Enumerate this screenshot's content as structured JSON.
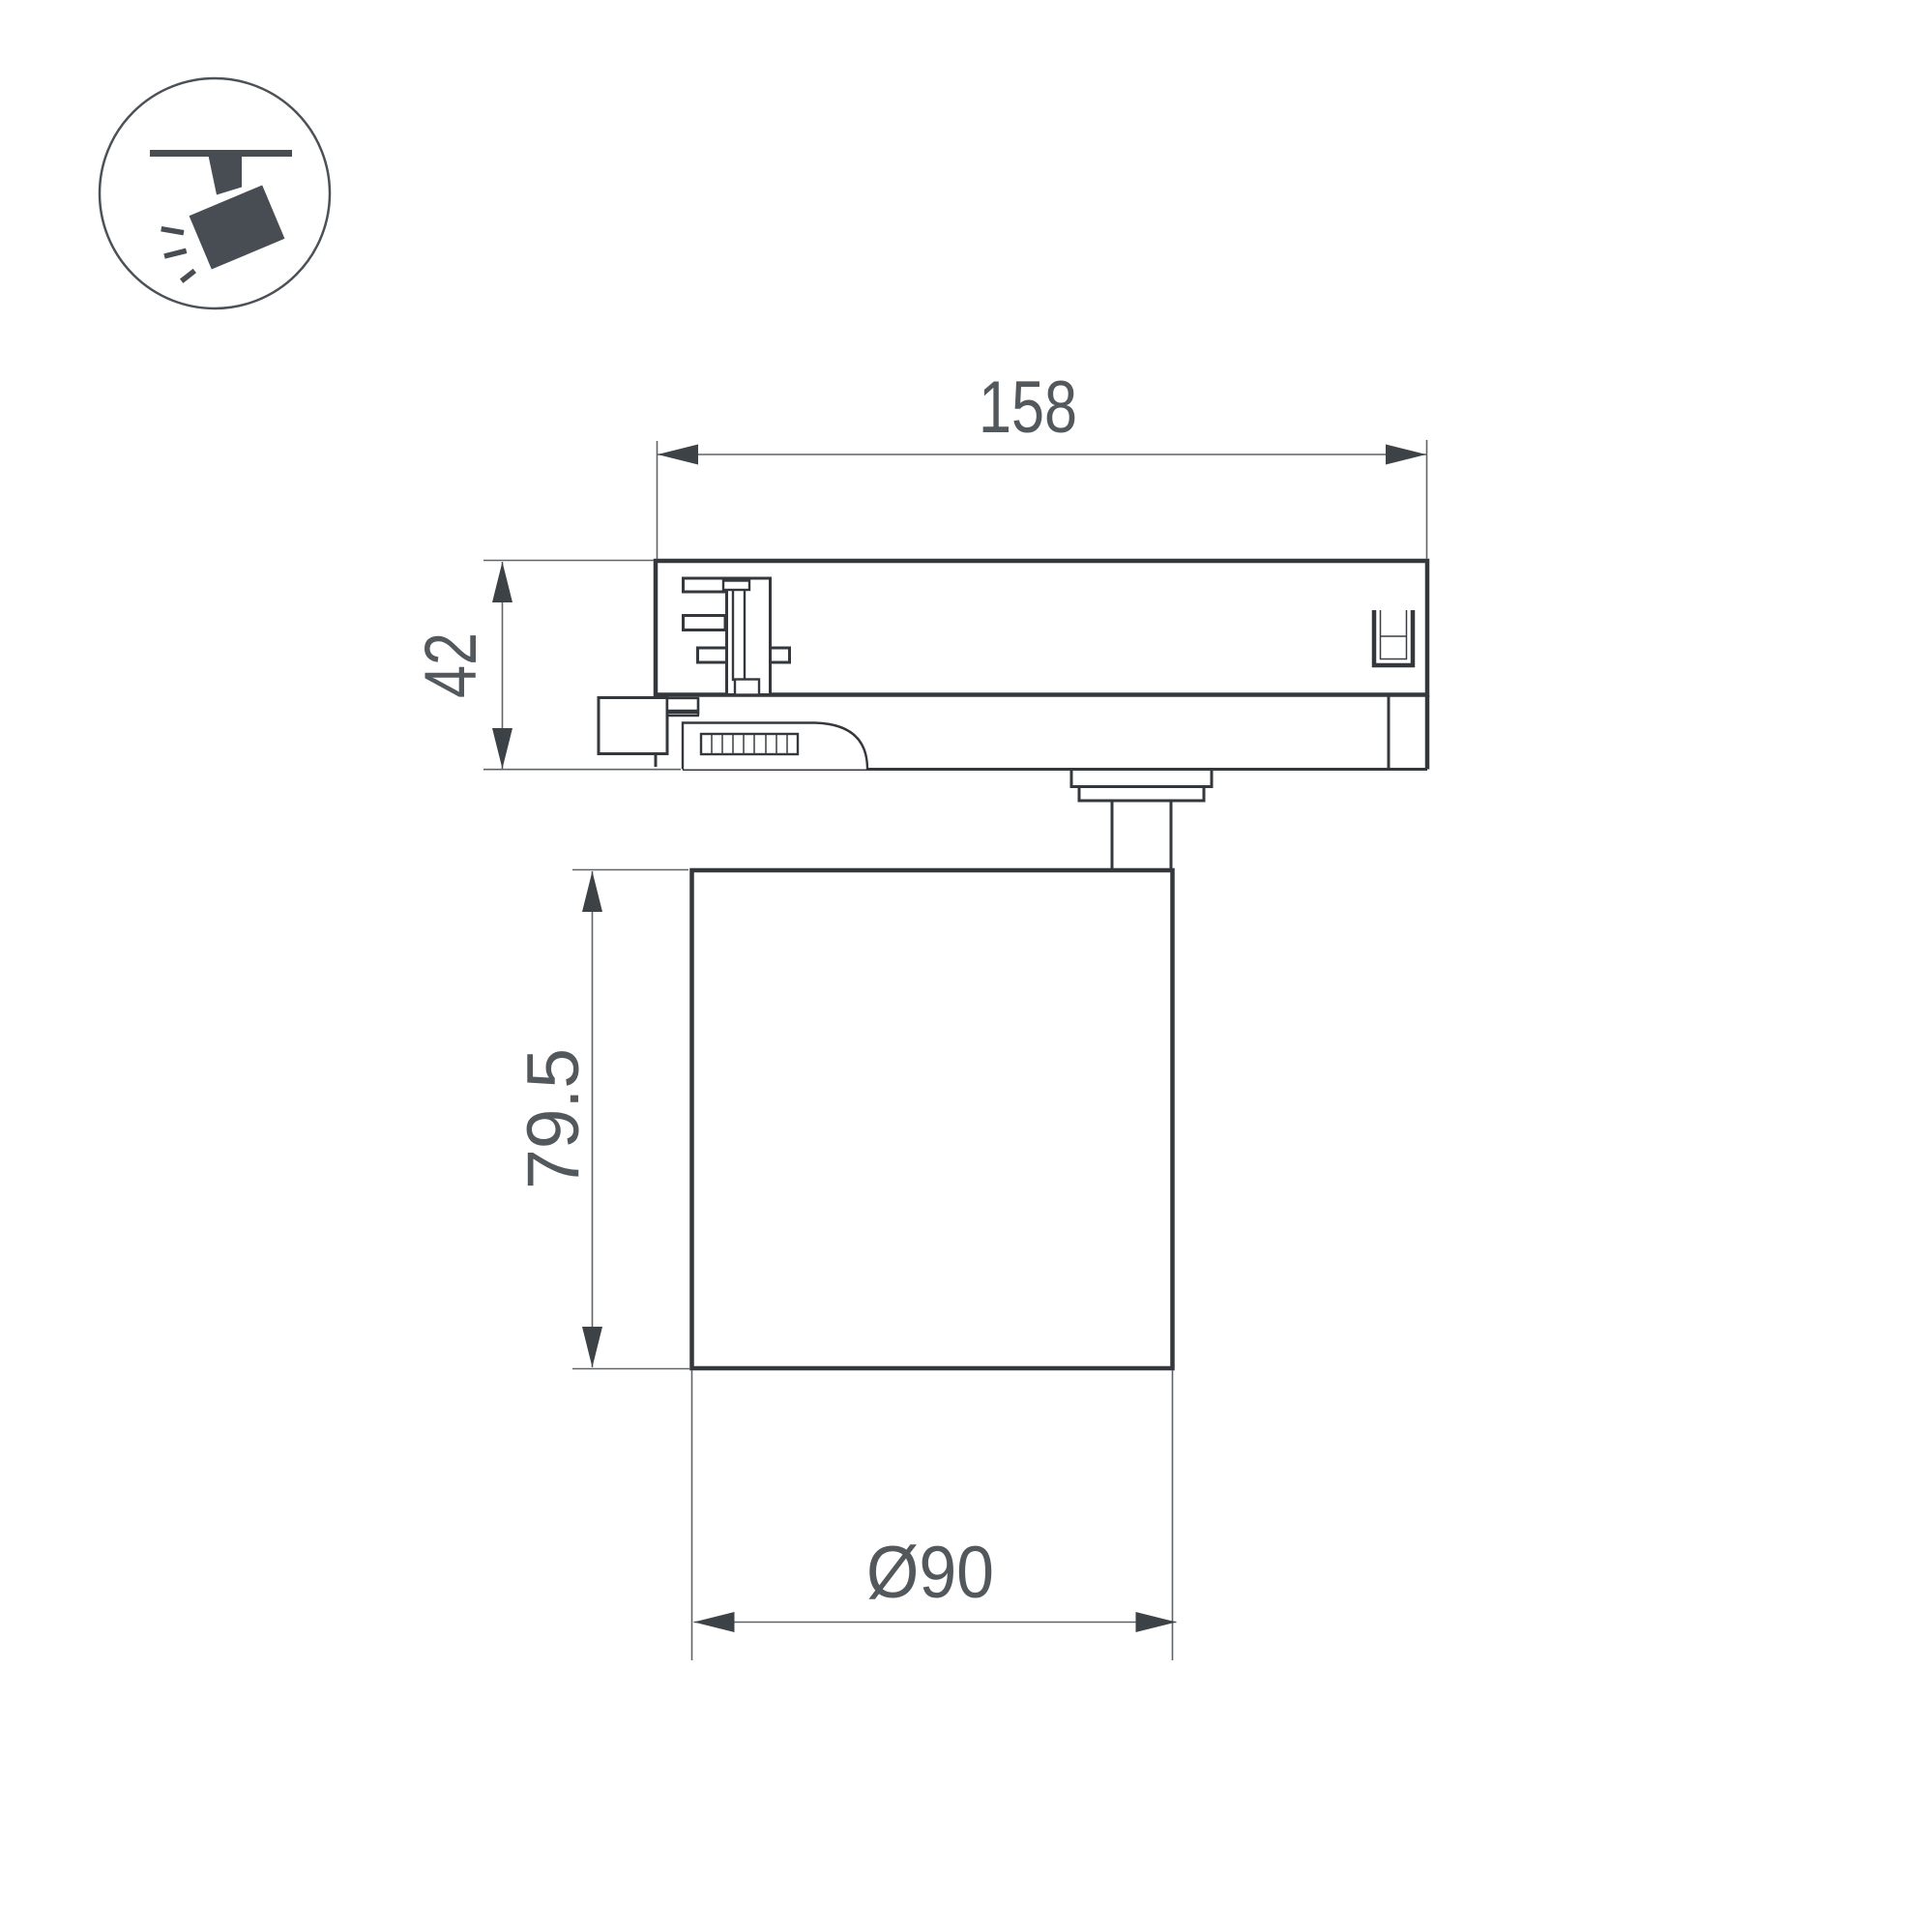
{
  "icon": {
    "name": "track-spotlight-pictogram",
    "description": "ceiling-track spotlight icon inside a circle"
  },
  "dimensions": {
    "track_width": {
      "label": "158"
    },
    "adapter_height": {
      "label": "42"
    },
    "body_height": {
      "label": "79.5"
    },
    "diameter": {
      "label": "Ø90"
    }
  },
  "colors": {
    "background": "#ffffff",
    "outline": "#34383c",
    "dimension_lines": "#5f6468",
    "dimension_text": "#53585c",
    "icon": "#474d52"
  }
}
